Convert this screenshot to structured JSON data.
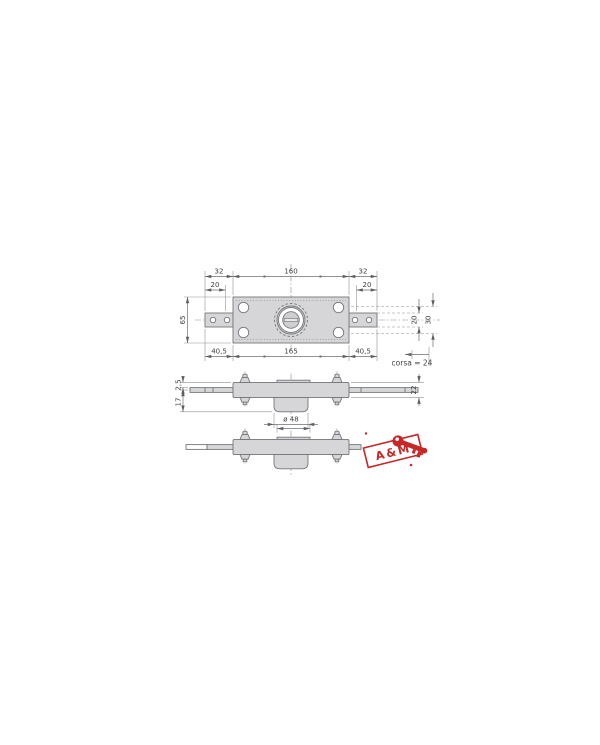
{
  "drawing": {
    "kind": "technical-drawing",
    "top_view": {
      "dims": {
        "span_left": "32",
        "span_center": "160",
        "span_right": "32",
        "hole_offset_left": "20",
        "hole_offset_right": "20",
        "plate_height": "65",
        "right_inner": "20",
        "right_outer": "30",
        "arm_left": "40,5",
        "plate_length": "165",
        "arm_right": "40,5",
        "stroke_note": "corsa = 24"
      }
    },
    "side_view": {
      "dims": {
        "rod_offset": "2,5",
        "cylinder_depth": "17",
        "case_thickness": "22",
        "cylinder_diameter": "ø 48"
      }
    }
  },
  "logo": {
    "stamp_text": "A&M"
  },
  "colors": {
    "background": "#ffffff",
    "line": "#74777b",
    "part_fill": "#d6d6d8",
    "dim_text": "#3f4144",
    "logo_red": "#c62828"
  }
}
